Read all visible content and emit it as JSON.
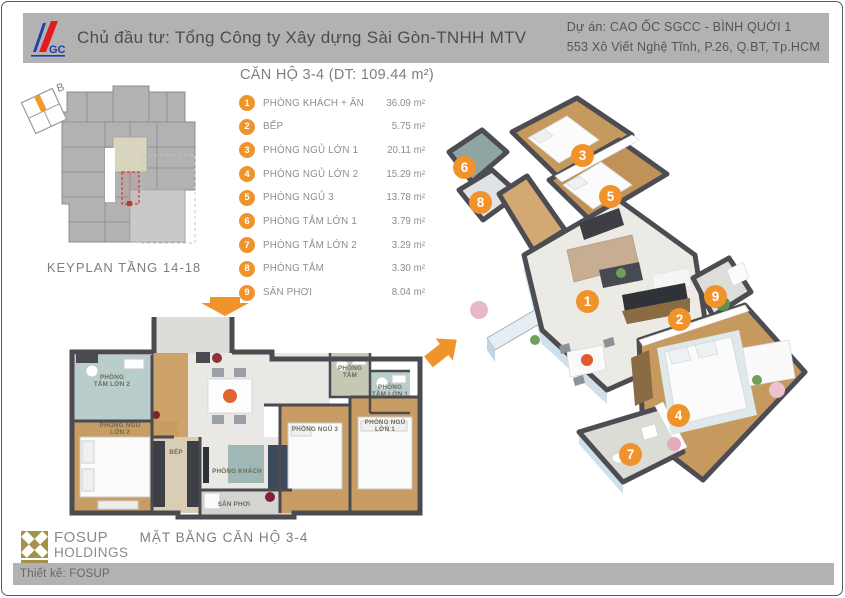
{
  "header": {
    "logo": "GC",
    "developer": "Chủ đầu tư: Tổng Công ty Xây dựng Sài Gòn-TNHH MTV",
    "project_name": "Dự án: CAO ỐC SGCC - BÌNH QUỚI 1",
    "project_address": "553 Xô Viết Nghệ Tĩnh, P.26, Q.BT, Tp.HCM"
  },
  "title": "CĂN HỘ 3-4 (DT: 109.44 m²)",
  "legend": {
    "items": [
      {
        "num": "1",
        "label": "PHÒNG KHÁCH + ĂN",
        "area": "36.09 m²"
      },
      {
        "num": "2",
        "label": "BẾP",
        "area": "5.75 m²"
      },
      {
        "num": "3",
        "label": "PHÒNG NGỦ LỚN 1",
        "area": "20.11 m²"
      },
      {
        "num": "4",
        "label": "PHÒNG NGỦ LỚN 2",
        "area": "15.29 m²"
      },
      {
        "num": "5",
        "label": "PHÒNG NGỦ 3",
        "area": "13.78 m²"
      },
      {
        "num": "6",
        "label": "PHÒNG TẮM LỚN 1",
        "area": "3.79 m²"
      },
      {
        "num": "7",
        "label": "PHÒNG TẮM LỚN 2",
        "area": "3.29 m²"
      },
      {
        "num": "8",
        "label": "PHÒNG TẮM",
        "area": "3.30 m²"
      },
      {
        "num": "9",
        "label": "SÂN PHƠI",
        "area": "8.04 m²"
      }
    ]
  },
  "keyplan": {
    "caption": "KEYPLAN TẦNG 14-18",
    "compass": "B"
  },
  "floorplan2d": {
    "caption": "MẶT BẰNG CĂN HỘ 3-4",
    "rooms": [
      {
        "label": "PHÒNG\nTẮM LỚN 2"
      },
      {
        "label": "PHÒNG NGỦ\nLỚN 2"
      },
      {
        "label": "BẾP"
      },
      {
        "label": "PHÒNG KHÁCH"
      },
      {
        "label": "SÂN PHƠI"
      },
      {
        "label": "PHÒNG\nTẮM"
      },
      {
        "label": "PHÒNG\nTẮM LỚN 1"
      },
      {
        "label": "PHÒNG NGỦ 3"
      },
      {
        "label": "PHÒNG NGỦ\nLỚN 1"
      }
    ]
  },
  "view3d": {
    "markers": [
      "1",
      "2",
      "3",
      "4",
      "5",
      "6",
      "7",
      "8",
      "9"
    ]
  },
  "branding": {
    "fosup_line1": "FOSUP",
    "fosup_line2": "HOLDINGS"
  },
  "footer": {
    "credit": "Thiết kế: FOSUP"
  },
  "colors": {
    "accent": "#F0932B",
    "header_bg": "#B2B2B2",
    "wall": "#4C4C52",
    "wood": "#C89D63",
    "bath": "#B9CECC",
    "red_highlight": "#D03A2F",
    "logo_blue": "#1D3FAE",
    "logo_red": "#E11A23",
    "fosup_gold": "#A3924A"
  }
}
